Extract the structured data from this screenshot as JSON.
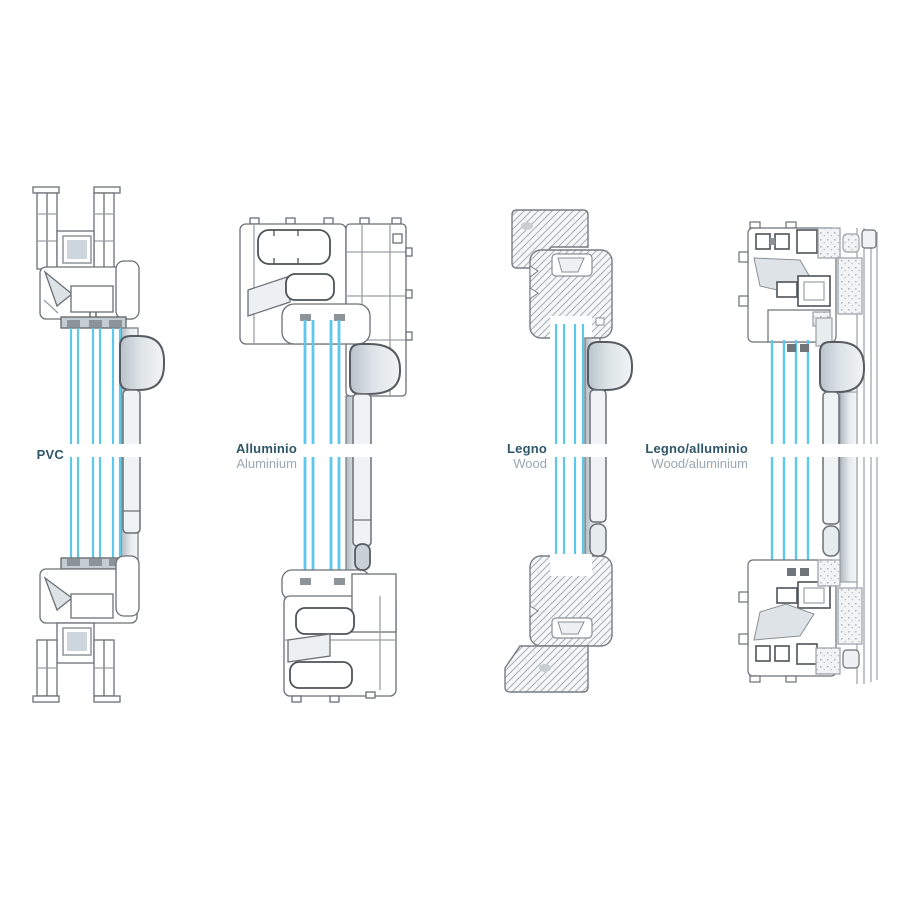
{
  "diagram": {
    "description": "Comparison of window frame cross-sections by material",
    "gap_band_y": 444,
    "colors": {
      "background": "#ffffff",
      "glass_blue": "#5ec7ec",
      "outline_grey": "#6a7076",
      "dark_chamber_grey": "#4d5358",
      "handle_grey": "#dde3e7",
      "label_title": "#2e5669",
      "label_subtitle": "#9aa8b2"
    },
    "profiles": [
      {
        "id": "pvc",
        "title": "PVC",
        "subtitle": "",
        "glazing_panes": 3
      },
      {
        "id": "aluminium",
        "title": "Alluminio",
        "subtitle": "Aluminium",
        "glazing_panes": 2
      },
      {
        "id": "wood",
        "title": "Legno",
        "subtitle": "Wood",
        "glazing_panes": 2
      },
      {
        "id": "wood-aluminium",
        "title": "Legno/alluminio",
        "subtitle": "Wood/aluminium",
        "glazing_panes": 3
      }
    ]
  }
}
